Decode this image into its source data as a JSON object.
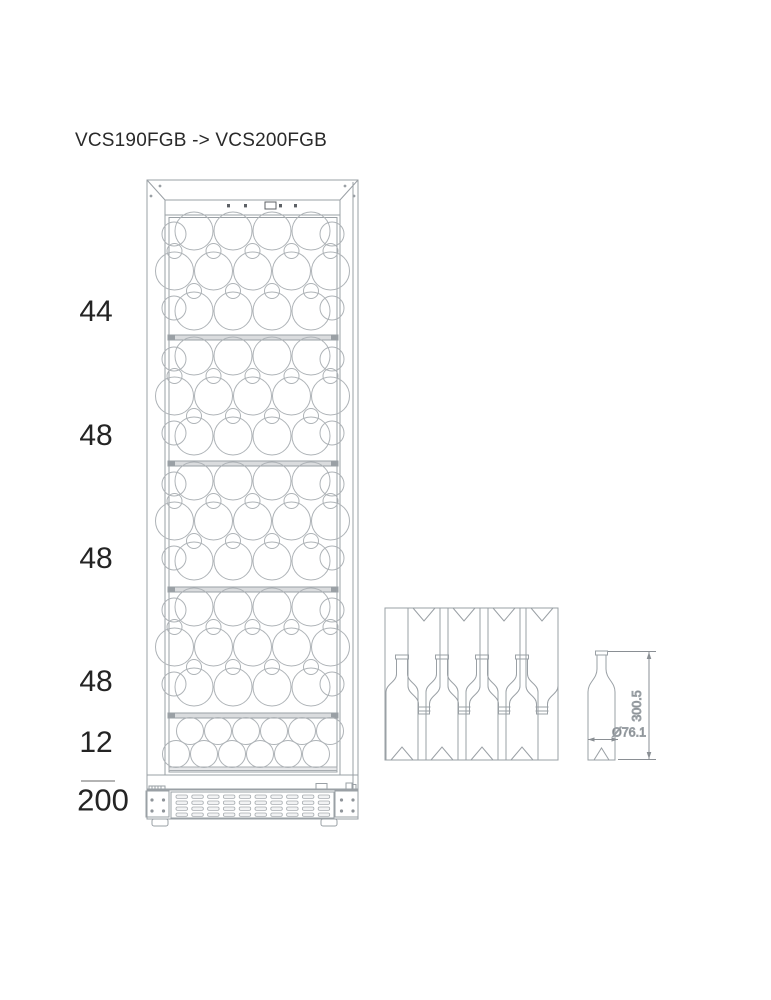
{
  "title": "VCS190FGB -> VCS200FGB",
  "capacity": {
    "sections": [
      {
        "label": "44"
      },
      {
        "label": "48"
      },
      {
        "label": "48"
      },
      {
        "label": "48"
      },
      {
        "label": "12"
      }
    ],
    "total": "200"
  },
  "bottle_dimensions": {
    "height": "300.5",
    "diameter": "Ø76.1"
  },
  "colors": {
    "line": "#9aa0a5",
    "dark_line": "#70757a",
    "shelf_fill": "#dadcde",
    "text": "#242424"
  }
}
